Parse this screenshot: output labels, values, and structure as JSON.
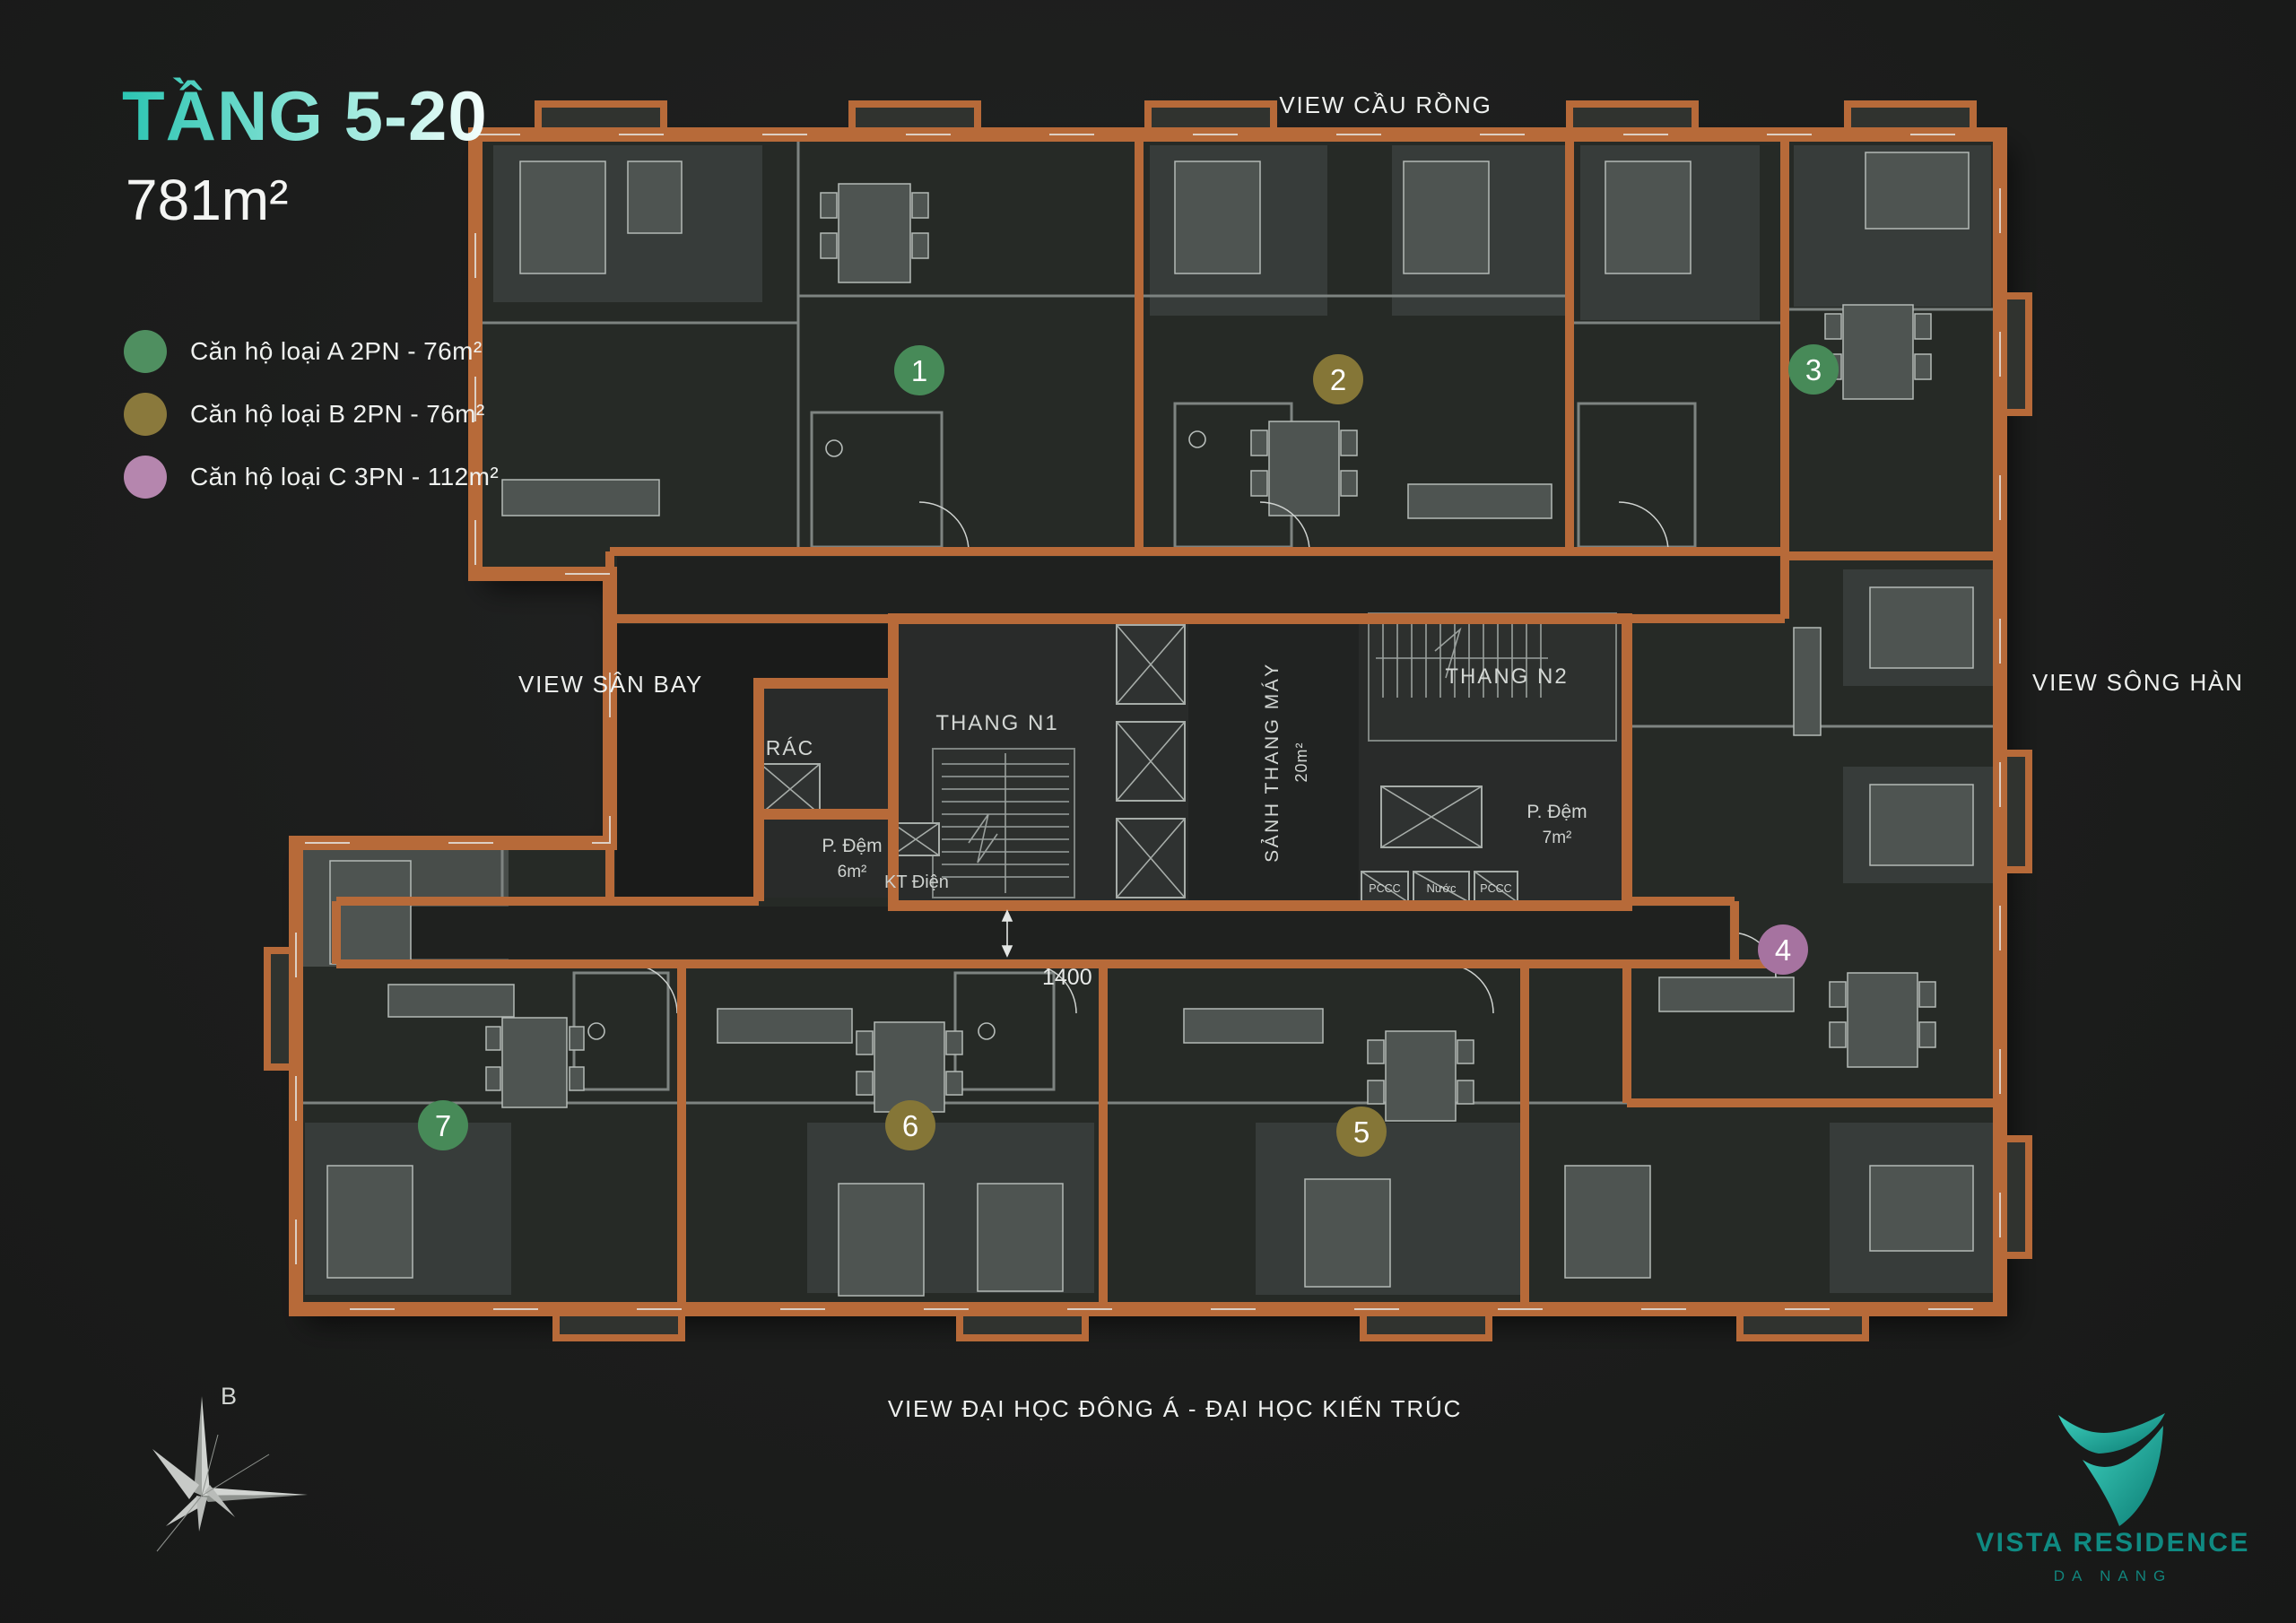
{
  "title": {
    "floor": "TẦNG 5-20",
    "area": "781m²"
  },
  "legend": [
    {
      "label": "Căn hộ loại A 2PN - 76m²",
      "color": "#4f8f60"
    },
    {
      "label": "Căn hộ loại B 2PN - 76m²",
      "color": "#8a793c"
    },
    {
      "label": "Căn hộ loại C 3PN - 112m²",
      "color": "#b586ae"
    }
  ],
  "views": {
    "top": "VIEW CẦU RỒNG",
    "left": "VIEW SÂN BAY",
    "right": "VIEW SÔNG HÀN",
    "bottom": "VIEW ĐẠI HỌC ĐÔNG Á - ĐẠI HỌC KIẾN TRÚC"
  },
  "compass": {
    "north": "B"
  },
  "logo": {
    "name": "VISTA RESIDENCE",
    "city": "DA NANG"
  },
  "plan": {
    "wall_color": "#b76a39",
    "core_labels": {
      "stair1": "THANG N1",
      "stair2": "THANG N2",
      "lobby": "SẢNH THANG MÁY",
      "lobby_area": "20m²",
      "buffer1": "P. Đệm",
      "buffer1_area": "6m²",
      "buffer2": "P. Đệm",
      "buffer2_area": "7m²",
      "electric": "KT Điện",
      "trash": "RÁC",
      "fire1": "PCCC",
      "water": "Nước",
      "fire2": "PCCC",
      "dimension": "1400"
    },
    "units": [
      {
        "number": "1",
        "type": "A",
        "color": "#478a58"
      },
      {
        "number": "2",
        "type": "B",
        "color": "#857637"
      },
      {
        "number": "3",
        "type": "A",
        "color": "#478a58"
      },
      {
        "number": "4",
        "type": "C",
        "color": "#a673a0"
      },
      {
        "number": "5",
        "type": "B",
        "color": "#857637"
      },
      {
        "number": "6",
        "type": "B",
        "color": "#857637"
      },
      {
        "number": "7",
        "type": "A",
        "color": "#478a58"
      }
    ]
  }
}
